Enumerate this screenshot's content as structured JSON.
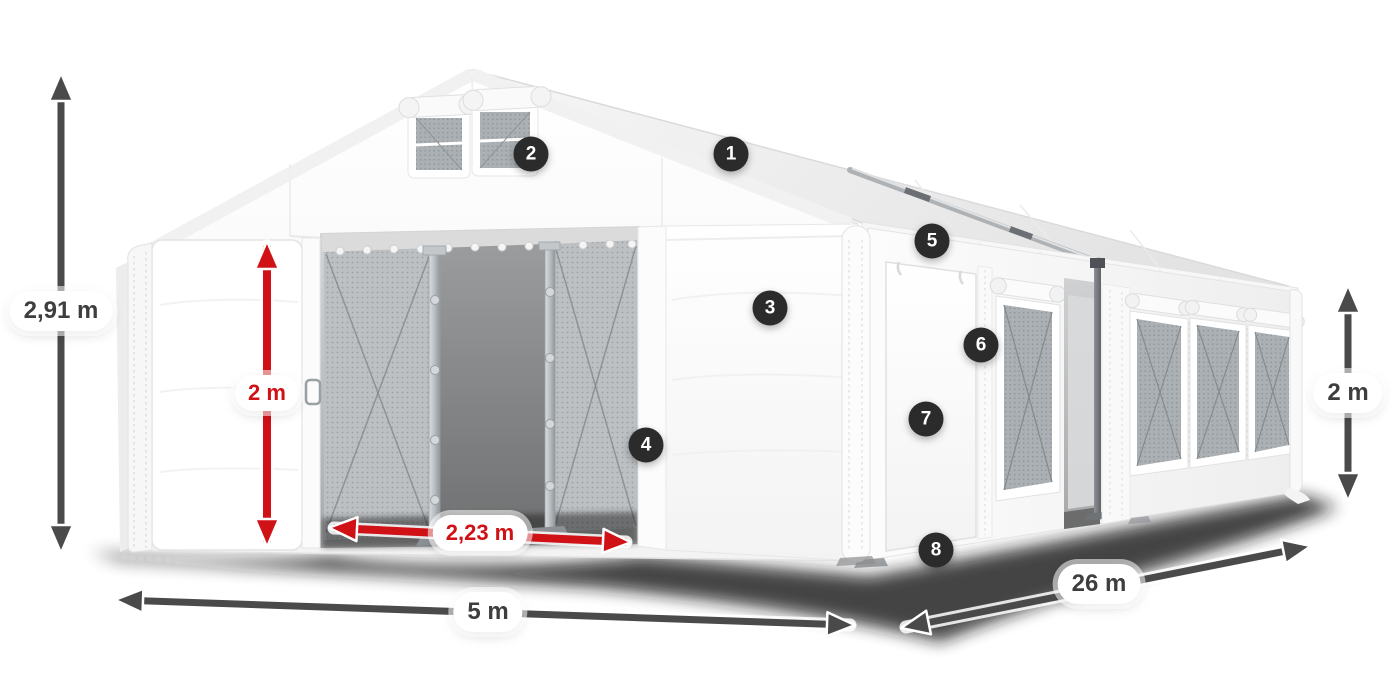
{
  "diagram": {
    "subject": "marquee-tent-with-dimensions"
  },
  "dimensions": {
    "total_height": {
      "value": "2,91 m",
      "style": "dark"
    },
    "door_height": {
      "value": "2 m",
      "style": "red"
    },
    "door_width": {
      "value": "2,23 m",
      "style": "red"
    },
    "gable_width": {
      "value": "5 m",
      "style": "dark"
    },
    "length": {
      "value": "26 m",
      "style": "dark"
    },
    "side_height": {
      "value": "2 m",
      "style": "dark"
    }
  },
  "callouts": [
    {
      "number": "1"
    },
    {
      "number": "2"
    },
    {
      "number": "3"
    },
    {
      "number": "4"
    },
    {
      "number": "5"
    },
    {
      "number": "6"
    },
    {
      "number": "7"
    },
    {
      "number": "8"
    }
  ],
  "colors": {
    "dimension_red": "#d01217",
    "dimension_dark": "#4a4a4a",
    "badge_background": "#2b2b2b",
    "badge_text": "#ffffff",
    "tent_white": "#ffffff",
    "mesh_gray": "#aab0b4"
  }
}
